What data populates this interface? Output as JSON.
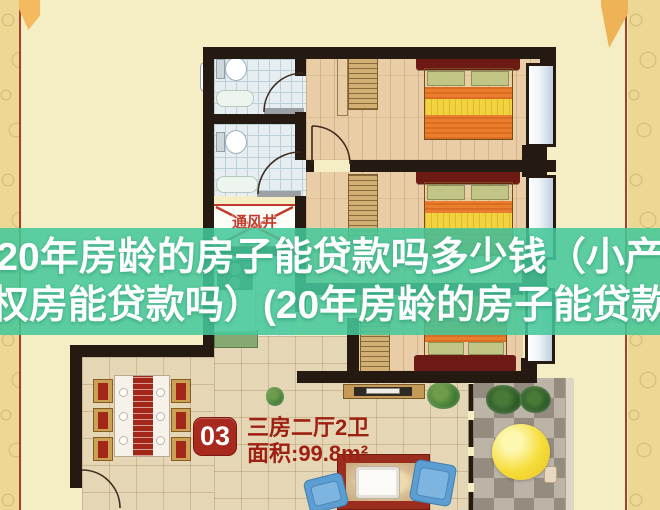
{
  "overlay": {
    "line1": "20年房龄的房子能贷款吗多少钱（小产",
    "line2": "权房能贷款吗）(20年房龄的房子能贷款",
    "band_color": "#45c89a",
    "text_color": "#ffffff"
  },
  "floorplan": {
    "unit_number": "03",
    "unit_type": "三房二厅2卫",
    "unit_area": "面积:99.8m²",
    "vent_shaft_label": "通风井"
  },
  "colors": {
    "page_background": "#f5eec4",
    "border_pattern": "#ecd894",
    "border_line_red": "#a5402a",
    "wall": "#241a12",
    "badge_red": "#a8291d",
    "label_red": "#9e2013",
    "vent_red": "#c0392b",
    "wood_floor": "#e9cda6",
    "tile_floor": "#e5d6b6",
    "bathroom_tile": "#e7eef2",
    "bed_blanket_orange": "#e97e2e",
    "bed_stripe_yellow": "#f2d23e",
    "armchair_blue": "#5c9ed1",
    "parasol_yellow": "#f6dd3a"
  }
}
